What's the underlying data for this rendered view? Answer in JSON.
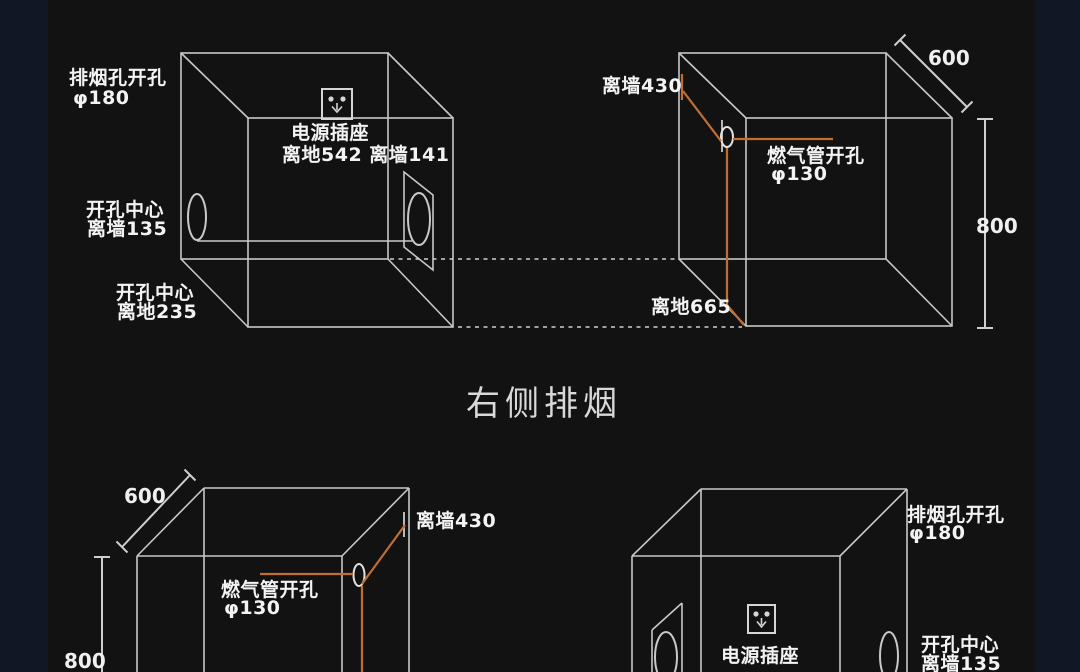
{
  "title": "右侧排烟",
  "colors": {
    "canvas_bg": "#121212",
    "page_edge_bg": "#121726",
    "wire": "#c7c9c9",
    "accent_orange": "#c26e33",
    "label_text": "#f3f3f3",
    "title_text": "#d9d9d9"
  },
  "top_left_cabinet": {
    "exhaust_hole_label": "排烟孔开孔",
    "exhaust_hole_dia": "φ180",
    "socket_label": "电源插座",
    "socket_dims": "离地542 离墙141",
    "hole_center_label_1": "开孔中心",
    "hole_center_wall": "离墙135",
    "hole_center_label_2": "开孔中心",
    "hole_center_floor": "离地235"
  },
  "top_right_cabinet": {
    "wall_offset": "离墙430",
    "gas_hole_label": "燃气管开孔",
    "gas_hole_dia": "φ130",
    "floor_offset": "离地665",
    "width_dim": "600",
    "height_dim": "800"
  },
  "bottom_left_cabinet": {
    "width_dim": "600",
    "wall_offset": "离墙430",
    "gas_hole_label": "燃气管开孔",
    "gas_hole_dia": "φ130",
    "height_dim": "800"
  },
  "bottom_right_cabinet": {
    "exhaust_hole_label": "排烟孔开孔",
    "exhaust_hole_dia": "φ180",
    "socket_label": "电源插座",
    "hole_center_label": "开孔中心",
    "hole_center_wall": "离墙135"
  }
}
